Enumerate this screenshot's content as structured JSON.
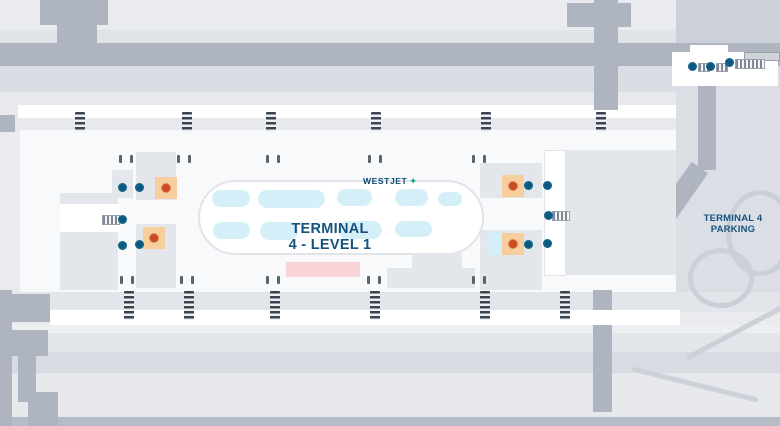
{
  "map": {
    "terminal_title_line1": "TERMINAL",
    "terminal_title_line2": "4 - LEVEL 1",
    "airline_logo_text": "WESTJET",
    "airline_logo_icon": "westjet-leaf-icon",
    "parking_label_line1": "TERMINAL 4",
    "parking_label_line2": "PARKING",
    "colors": {
      "background": "#e9ebee",
      "road_gray": "#aeb5c1",
      "building_gray": "#e3e6ea",
      "carousel_cyan": "#d5eff8",
      "navy_text": "#15537e",
      "westjet_navy": "#0c4871",
      "westjet_teal": "#00a390",
      "info_square_orange": "#f7cf9f",
      "info_dot_orange": "#cd4a27",
      "elevator_blue": "#0d577f",
      "highlight_pink": "#f8d3d7",
      "crosswalk_dark": "#3a434f"
    },
    "markers": {
      "elevators": [
        [
          122,
          187
        ],
        [
          139,
          187
        ],
        [
          122,
          219
        ],
        [
          122,
          245
        ],
        [
          139,
          244
        ],
        [
          528,
          185
        ],
        [
          547,
          185
        ],
        [
          548,
          215
        ],
        [
          528,
          244
        ],
        [
          547,
          243
        ],
        [
          692,
          66
        ],
        [
          710,
          66
        ],
        [
          729,
          62
        ]
      ],
      "escalators": [
        [
          102,
          215,
          16,
          8
        ],
        [
          552,
          211,
          16,
          8
        ],
        [
          698,
          63,
          10,
          7
        ],
        [
          716,
          63,
          10,
          7
        ],
        [
          735,
          59,
          28,
          8
        ]
      ],
      "info_points": [
        [
          155,
          177
        ],
        [
          143,
          227
        ],
        [
          502,
          175
        ],
        [
          502,
          233
        ]
      ]
    },
    "baggage_carousels": [
      [
        212,
        190,
        38,
        17
      ],
      [
        258,
        190,
        67,
        18
      ],
      [
        337,
        189,
        35,
        17
      ],
      [
        395,
        189,
        33,
        17
      ],
      [
        438,
        192,
        24,
        14
      ],
      [
        213,
        222,
        37,
        17
      ],
      [
        260,
        222,
        38,
        18
      ],
      [
        338,
        221,
        44,
        18
      ],
      [
        395,
        221,
        37,
        16
      ]
    ],
    "crosswalks": {
      "top": {
        "y": 112,
        "h": 20,
        "xs": [
          75,
          182,
          266,
          371,
          481,
          596
        ]
      },
      "bottom": {
        "y": 291,
        "h": 29,
        "xs": [
          124,
          184,
          270,
          370,
          480,
          560
        ]
      }
    },
    "door_ticks": {
      "top": {
        "y": 155,
        "xs": [
          119,
          130,
          177,
          188,
          266,
          277,
          368,
          379,
          472,
          483
        ]
      },
      "bottom": {
        "y": 276,
        "xs": [
          120,
          131,
          180,
          191,
          266,
          277,
          367,
          378,
          472,
          483
        ]
      }
    }
  }
}
